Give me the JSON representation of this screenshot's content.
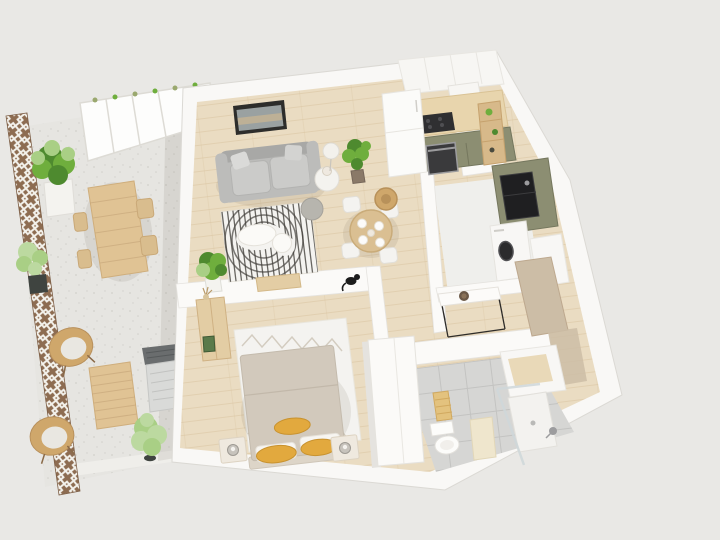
{
  "scene": {
    "type": "3d-floorplan-render",
    "view": "isometric top-down architectural visualization",
    "description": "One-bedroom apartment with large terrace, rendered in 3D on a plain light grey background. No text labels are visible.",
    "rooms": [
      {
        "name": "terrace",
        "floor": "speckled light concrete",
        "items": [
          "lattice fence",
          "glass canopy pergola",
          "large potted plant",
          "small potted plant",
          "wooden outdoor dining table",
          "four outdoor chairs",
          "two rattan lounge chairs with cushions",
          "slatted wooden coffee table",
          "outdoor bush plant",
          "air conditioning unit"
        ]
      },
      {
        "name": "living-room",
        "floor": "light oak planks",
        "items": [
          "framed wall art",
          "grey three-seat sofa with cushions",
          "round side table with lamp",
          "sphere floor lamp",
          "tall potted plant",
          "arc striped rug",
          "white organic coffee table",
          "grey pouf",
          "corner plant",
          "wooden media bench",
          "round wooden dining table",
          "four white dining chairs",
          "table setting with plates",
          "rattan pendant basket",
          "black cat sitting on half wall"
        ]
      },
      {
        "name": "kitchen",
        "floor": "light oak planks",
        "items": [
          "white upper cabinets",
          "extractor unit",
          "wooden countertop",
          "dark induction cooktop",
          "built-in oven",
          "olive green base cabinets",
          "tall white fridge column",
          "wooden ladder shelf with plants",
          "corner cabinet",
          "green sink unit",
          "black sink with faucet"
        ]
      },
      {
        "name": "utility-room",
        "floor": "pale grey",
        "items": [
          "washing machine with dark door",
          "white storage counter"
        ]
      },
      {
        "name": "hallway",
        "floor": "light oak planks",
        "items": [
          "console table with thin black legs",
          "decorative bowl",
          "open wooden door panels"
        ]
      },
      {
        "name": "bedroom",
        "floor": "light oak planks",
        "items": [
          "double bed with beige duvet",
          "three mustard yellow pillows",
          "two white pillows",
          "two nightstands with sphere lamps",
          "diamond pattern white rug",
          "wooden sideboard with dried plant and green frame",
          "white wardrobe"
        ]
      },
      {
        "name": "bathroom",
        "floor": "grey tiles",
        "items": [
          "toilet",
          "wooden bath mat",
          "beige bath mat",
          "walk-in shower with glass screen",
          "white shower tray",
          "vanity unit with wooden counter"
        ]
      }
    ]
  },
  "colors": {
    "bg": "#e9e8e5",
    "slab": "#f9f8f6",
    "wall": "#fbfaf8",
    "wall_shade": "#e5e3df",
    "wood_floor": "#eadcc2",
    "wood_line": "#d9c5a1",
    "terrace_floor": "#e6e5e1",
    "terrace_dot": "#d2d1cc",
    "paving": "#efeeea",
    "fence": "#8d6c51",
    "lattice_line": "#f3f1eb",
    "canopy": "#fdfdfc",
    "canopy_line": "#dddbd5",
    "hedge": "#9aa86e",
    "plant_dark": "#4e8a2f",
    "plant_mid": "#6fae3d",
    "plant_light": "#a9cf85",
    "plant_pale": "#bcd9a0",
    "planter_white": "#f4f3ef",
    "planter_dark": "#3f4440",
    "outdoor_wood": "#e0c394",
    "outdoor_wood_line": "#c7a77a",
    "outdoor_chair": "#d9bd8e",
    "rattan": "#cfa76b",
    "cushion": "#e9e7e1",
    "ac_top": "#6a6d6e",
    "ac_body": "#d9dad8",
    "sofa": "#bcbcba",
    "sofa_dark": "#a8a8a6",
    "sofa_light": "#cbcbc9",
    "art_frame": "#2d2d2b",
    "art_image": "#9aa1a1",
    "art_tan": "#c3b394",
    "rug_white": "#f4f3f0",
    "rug_stripe": "#45423d",
    "coffee_table": "#fbfaf7",
    "pouf": "#b7b5ae",
    "dining_table": "#dabf92",
    "chair_white": "#f4f3f0",
    "plate": "#fcfbf9",
    "upper_cabinet": "#f7f6f3",
    "countertop": "#e8d5ad",
    "cooktop": "#2f2f31",
    "cabinet_green": "#8c8e72",
    "cabinet_green_dark": "#75775e",
    "oven": "#3a3a3c",
    "steel": "#9c9c9e",
    "fridge": "#fbfbf9",
    "shelf_wood": "#d7b98a",
    "sink_black": "#1f1f21",
    "utility_floor": "#efefec",
    "appliance_white": "#f8f7f5",
    "washer_door": "#2b2b2d",
    "console_white": "#fcfbf9",
    "console_leg": "#2e2c29",
    "bowl": "#6b5846",
    "door_wood": "#ccbda6",
    "tile": "#d6d6d4",
    "tile_line": "#c3c3c1",
    "toilet": "#fcfcfa",
    "mat_wood": "#e3c27e",
    "mat_beige": "#efe6cd",
    "shower_tray": "#f3f2ef",
    "glass": "#cfd8da",
    "duvet": "#d2c9bc",
    "duvet_line": "#bfb5a6",
    "pillow_white": "#f7f5f1",
    "pillow_yellow": "#e2a93e",
    "nightstand": "#efe9df",
    "lamp_grey": "#c7c3bc",
    "wardrobe": "#fbfaf8",
    "sideboard": "#e3cda4",
    "frame_green": "#5a7a4a",
    "cat": "#1c1c1c",
    "vanity_top": "#e9d9b8",
    "shadow": "rgba(90,80,60,0.10)"
  }
}
